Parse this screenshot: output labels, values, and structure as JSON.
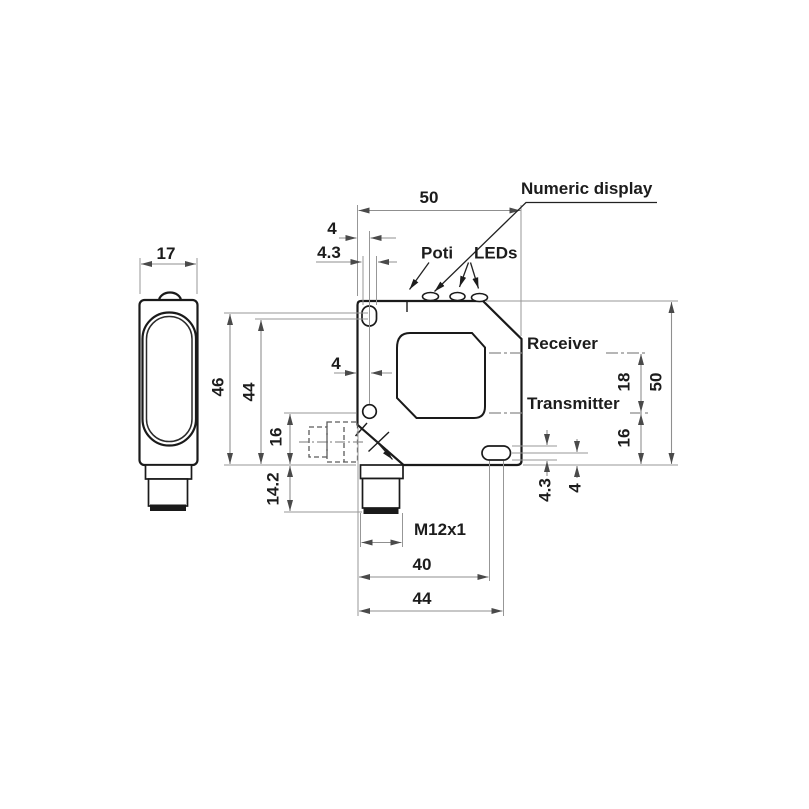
{
  "labels": {
    "numeric_display": "Numeric display",
    "poti": "Poti",
    "leds": "LEDs",
    "receiver": "Receiver",
    "transmitter": "Transmitter",
    "thread": "M12x1"
  },
  "dims": {
    "front_width": "50",
    "hole_offset_top": "4",
    "hole_dia_top": "4.3",
    "side_width": "17",
    "height_to_slot_top": "46",
    "height_to_slot_bottom": "44",
    "lens_edge_offset": "4",
    "receiver_transmitter_spacing": "18",
    "front_height": "50",
    "transmitter_to_bottom_right": "16",
    "slot_dia_bottom": "4.3",
    "slot_offset_bottom": "4",
    "transmitter_to_bottom_left": "16",
    "connector_length": "14.2",
    "width_to_slot_left_arc": "40",
    "width_to_slot_right_arc": "44"
  },
  "colors": {
    "background": "#ffffff",
    "part_outline": "#1a1a1a",
    "dimension_lines": "#8f8f8f",
    "text": "#1c1c1c"
  }
}
